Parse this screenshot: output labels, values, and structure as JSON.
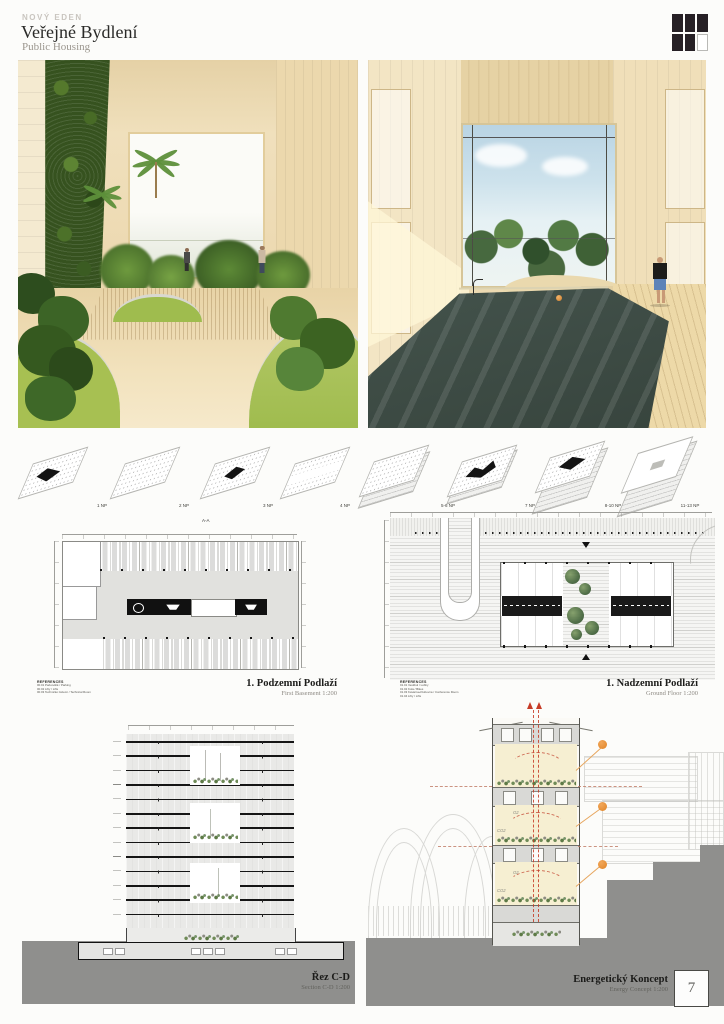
{
  "header": {
    "project_label": "NOVÝ EDEN",
    "title": "Veřejné Bydlení",
    "subtitle": "Public Housing"
  },
  "axonometrics": {
    "labels": [
      "1 NP",
      "2 NP",
      "3 NP",
      "4 NP",
      "5-6 NP",
      "7 NP",
      "8-10 NP",
      "11-13 NP"
    ],
    "section_marker": "A-A"
  },
  "basement_plan": {
    "title": "1. Podzemní Podlaží",
    "subtitle": "First Basement 1:200",
    "references_heading": "REFERENCES",
    "references": [
      "00.01  Parkoviště / Parking",
      "00.02  Lifty / Lifts",
      "00.03  Technické zázemí / Technical Room"
    ]
  },
  "ground_plan": {
    "title": "1. Nadzemní Podlaží",
    "subtitle": "Ground Floor 1:200",
    "references_heading": "REFERENCES",
    "references": [
      "01.01  Vestibul / Lobby",
      "01.02  Kola / Bikes",
      "01.03  Kavárna+Klubovna / Conference Room",
      "01.04  Lifty / Lifts"
    ]
  },
  "section_drawing": {
    "title": "Řez C-D",
    "subtitle": "Section C-D 1:200"
  },
  "energy_concept": {
    "title": "Energetický Koncept",
    "subtitle": "Energy Concept 1:200",
    "o2_label": "O2",
    "co2_label": "CO2"
  },
  "sheet_number": "7",
  "colors": {
    "accent_orange": "#e08426",
    "flow_red": "#c63b26",
    "ground_gray": "#8f8f8d",
    "wood": "#ecd9b0",
    "logo_dark": "#262025"
  }
}
